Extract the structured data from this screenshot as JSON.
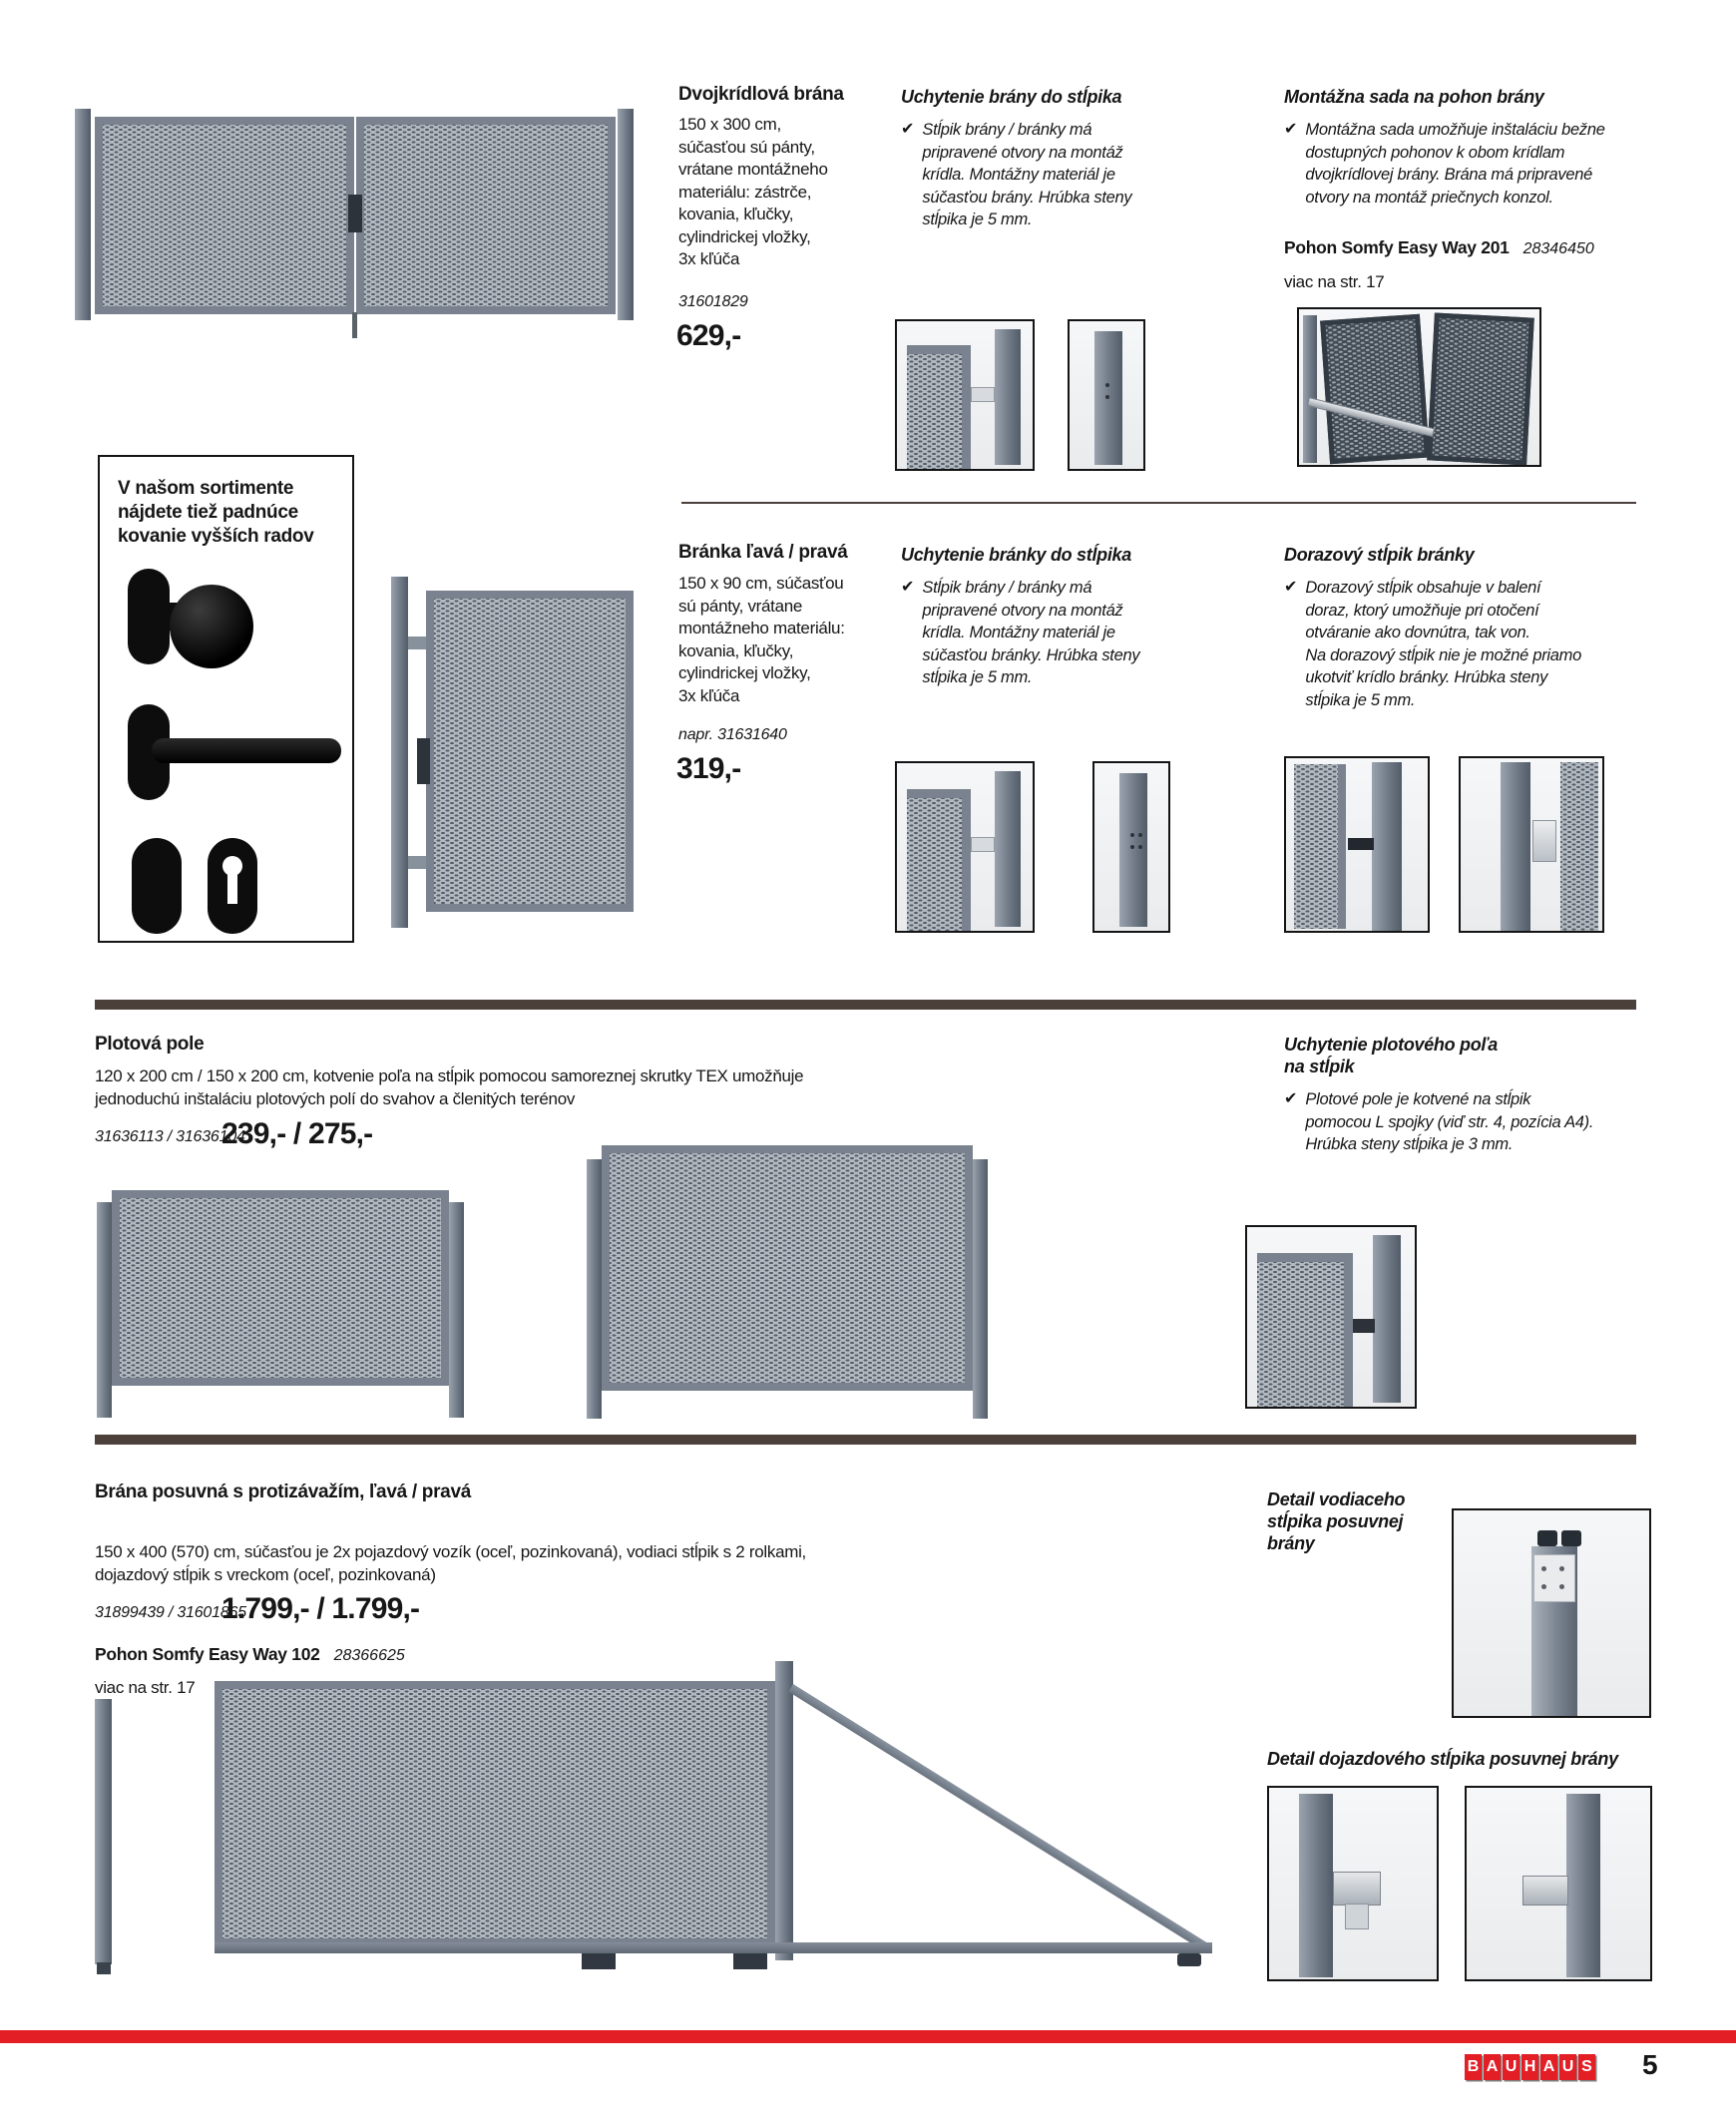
{
  "glyphs": {
    "check": "✔"
  },
  "colors": {
    "bauhaus_red": "#e31e25",
    "divider_brown": "#4c403b"
  },
  "s1": {
    "title": "Dvojkrídlová brána",
    "desc": "150 x 300 cm,\nsúčasťou sú pánty,\nvrátane montážneho\nmateriálu: zástrče,\nkovania, kľučky,\ncylindrickej vložky,\n3x kľúča",
    "sku": "31601829",
    "price": "629,-",
    "info1_title": "Uchytenie brány do stĺpika",
    "info1_text": "Stĺpik brány / bránky má\npripravené otvory na montáž\nkrídla. Montážny materiál je\nsúčasťou brány. Hrúbka steny\nstĺpika je 5 mm.",
    "info2_title": "Montážna sada na pohon brány",
    "info2_text": "Montážna sada umožňuje inštaláciu bežne\ndostupných pohonov k obom krídlam\ndvojkrídlovej brány. Brána má pripravené\notvory na montáž priečnych konzol.",
    "pohon_name": "Pohon Somfy Easy Way 201",
    "pohon_sku": "28346450",
    "pohon_more": "viac na str. 17"
  },
  "s2": {
    "box_note": "V našom sortimente\nnájdete tiež padnúce\nkovanie vyšších radov",
    "title": "Bránka ľavá / pravá",
    "desc": "150 x 90 cm, súčasťou\nsú pánty, vrátane\nmontážneho materiálu:\nkovania, kľučky,\ncylindrickej vložky,\n3x kľúča",
    "sku": "napr. 31631640",
    "price": "319,-",
    "info1_title": "Uchytenie bránky do stĺpika",
    "info1_text": "Stĺpik brány / bránky má\npripravené otvory na montáž\nkrídla. Montážny materiál je\nsúčasťou bránky. Hrúbka steny\nstĺpika je 5 mm.",
    "info2_title": "Dorazový stĺpik bránky",
    "info2_text": "Dorazový stĺpik obsahuje v balení\ndoraz, ktorý umožňuje pri otočení\notváranie ako dovnútra, tak von.\nNa dorazový stĺpik nie je možné priamo\nukotviť krídlo bránky. Hrúbka steny\nstĺpika je 5 mm."
  },
  "s3": {
    "title": "Plotová pole",
    "desc": "120 x 200 cm / 150 x 200 cm, kotvenie poľa na stĺpik pomocou samoreznej skrutky TEX umožňuje\njednoduchú inštaláciu plotových polí do svahov a členitých terénov",
    "sku": "31636113 / 31636104",
    "price": "239,- / 275,-",
    "info_title": "Uchytenie plotového poľa\nna stĺpik",
    "info_text": "Plotové pole je kotvené na stĺpik\npomocou L spojky (viď str. 4, pozícia A4).\nHrúbka steny stĺpika je 3 mm."
  },
  "s4": {
    "title": "Brána posuvná s protizávažím, ľavá / pravá",
    "desc": "150 x 400 (570) cm, súčasťou je 2x pojazdový vozík (oceľ, pozinkovaná), vodiaci stĺpik s 2 rolkami,\ndojazdový stĺpik s vreckom (oceľ, pozinkovaná)",
    "sku": "31899439 / 31601865",
    "price": "1.799,- / 1.799,-",
    "pohon_name": "Pohon Somfy Easy Way 102",
    "pohon_sku": "28366625",
    "pohon_more": "viac na str. 17",
    "detail1_title": "Detail vodiaceho\nstĺpika posuvnej\nbrány",
    "detail2_title": "Detail dojazdového stĺpika posuvnej brány"
  },
  "footer": {
    "brand_letters": [
      "B",
      "A",
      "U",
      "H",
      "A",
      "U",
      "S"
    ],
    "page_number": "5"
  }
}
